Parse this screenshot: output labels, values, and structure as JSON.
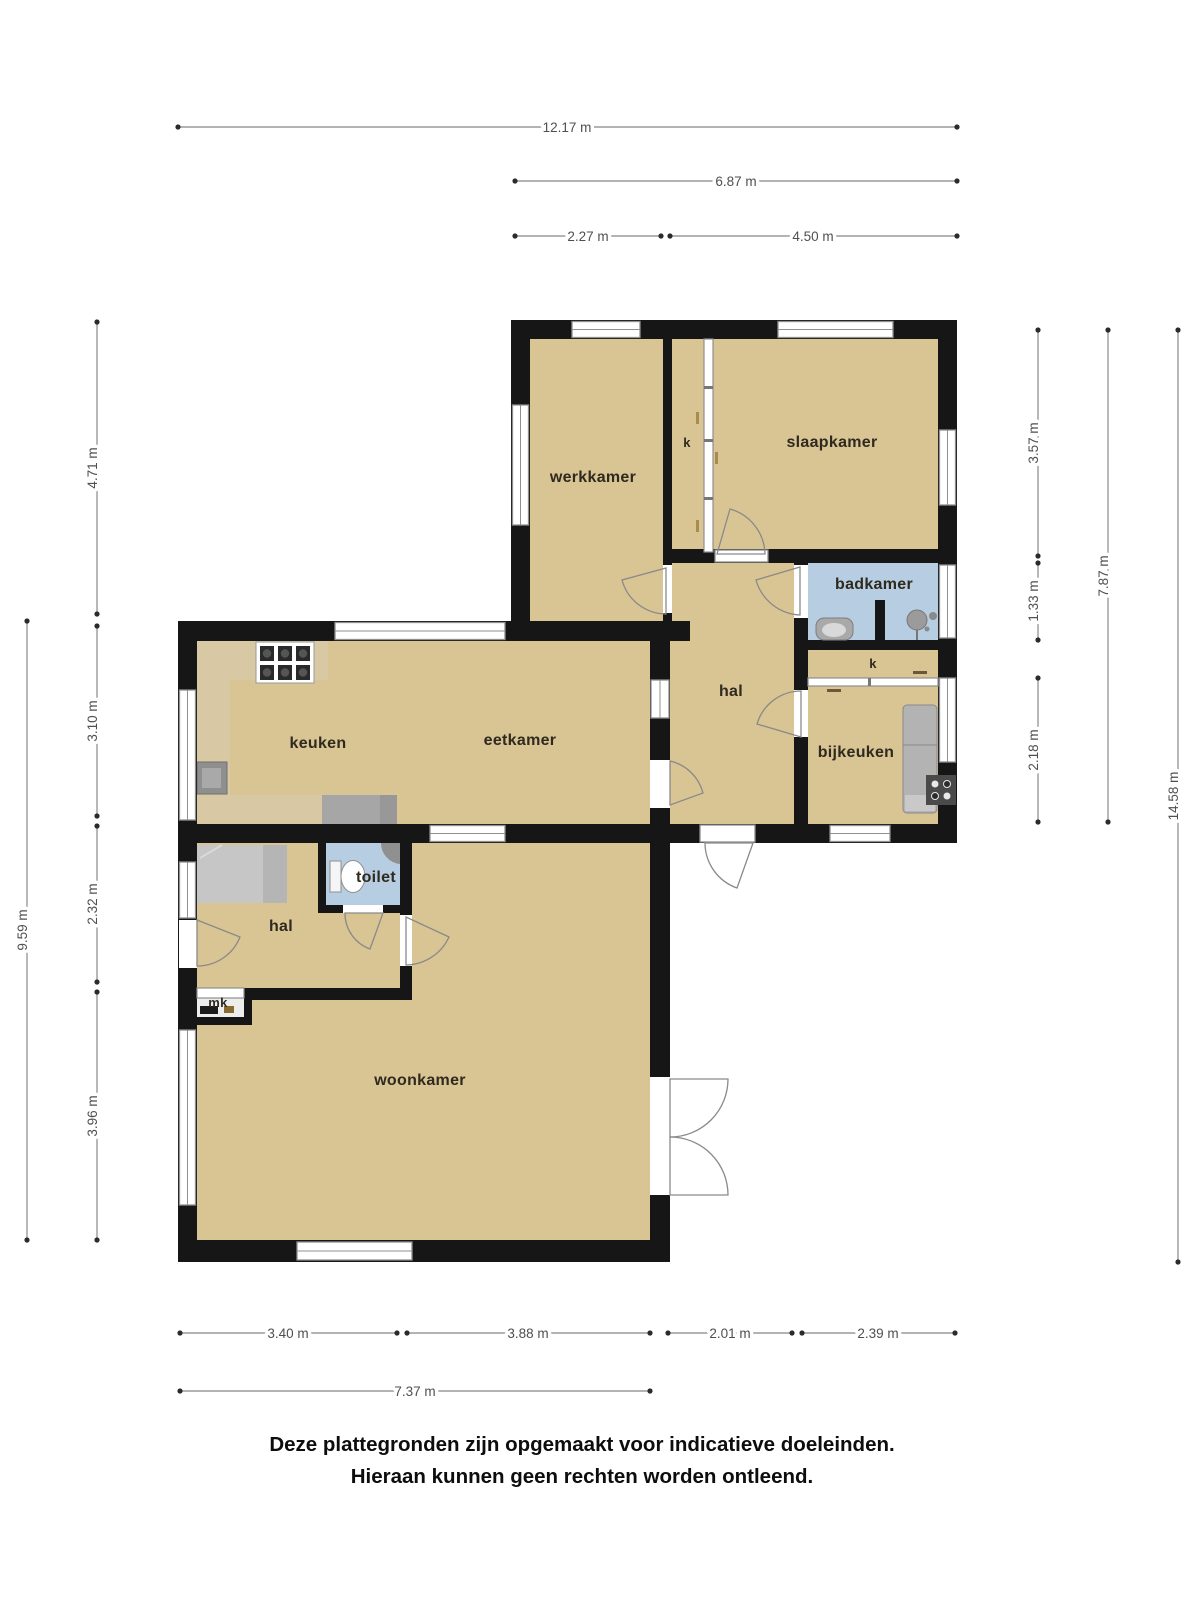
{
  "plan_type": "floor-plan",
  "rooms": {
    "werkkamer": "werkkamer",
    "kast_boven": "k",
    "slaapkamer": "slaapkamer",
    "badkamer": "badkamer",
    "hal_boven": "hal",
    "kast_bijkeuken": "k",
    "bijkeuken": "bijkeuken",
    "keuken": "keuken",
    "eetkamer": "eetkamer",
    "toilet": "toilet",
    "hal_beneden": "hal",
    "meterkast": "mk",
    "woonkamer": "woonkamer"
  },
  "dimensions": {
    "top": [
      "12.17 m",
      "6.87 m",
      "2.27 m",
      "4.50 m"
    ],
    "left": [
      "4.71 m",
      "3.10 m",
      "2.32 m",
      "3.96 m",
      "9.59 m"
    ],
    "right": [
      "3.57 m",
      "1.33 m",
      "2.18 m",
      "7.87 m",
      "14.58 m"
    ],
    "bottom": [
      "3.40 m",
      "3.88 m",
      "2.01 m",
      "2.39 m",
      "7.37 m"
    ]
  },
  "footer": {
    "line1": "Deze plattegronden zijn opgemaakt voor indicatieve doeleinden.",
    "line2": "Hieraan kunnen geen rechten worden ontleend."
  },
  "colors": {
    "floor": "#d9c493",
    "counter": "#d8c9a4",
    "wet_room": "#b7cde2",
    "wall": "#161616",
    "window_frame": "#8f8f8f",
    "fixture_gray": "#a6a6a6",
    "dimension_line": "#9a9a9a",
    "dimension_text": "#4f4f4f",
    "room_label_text": "#2e2a1f"
  }
}
